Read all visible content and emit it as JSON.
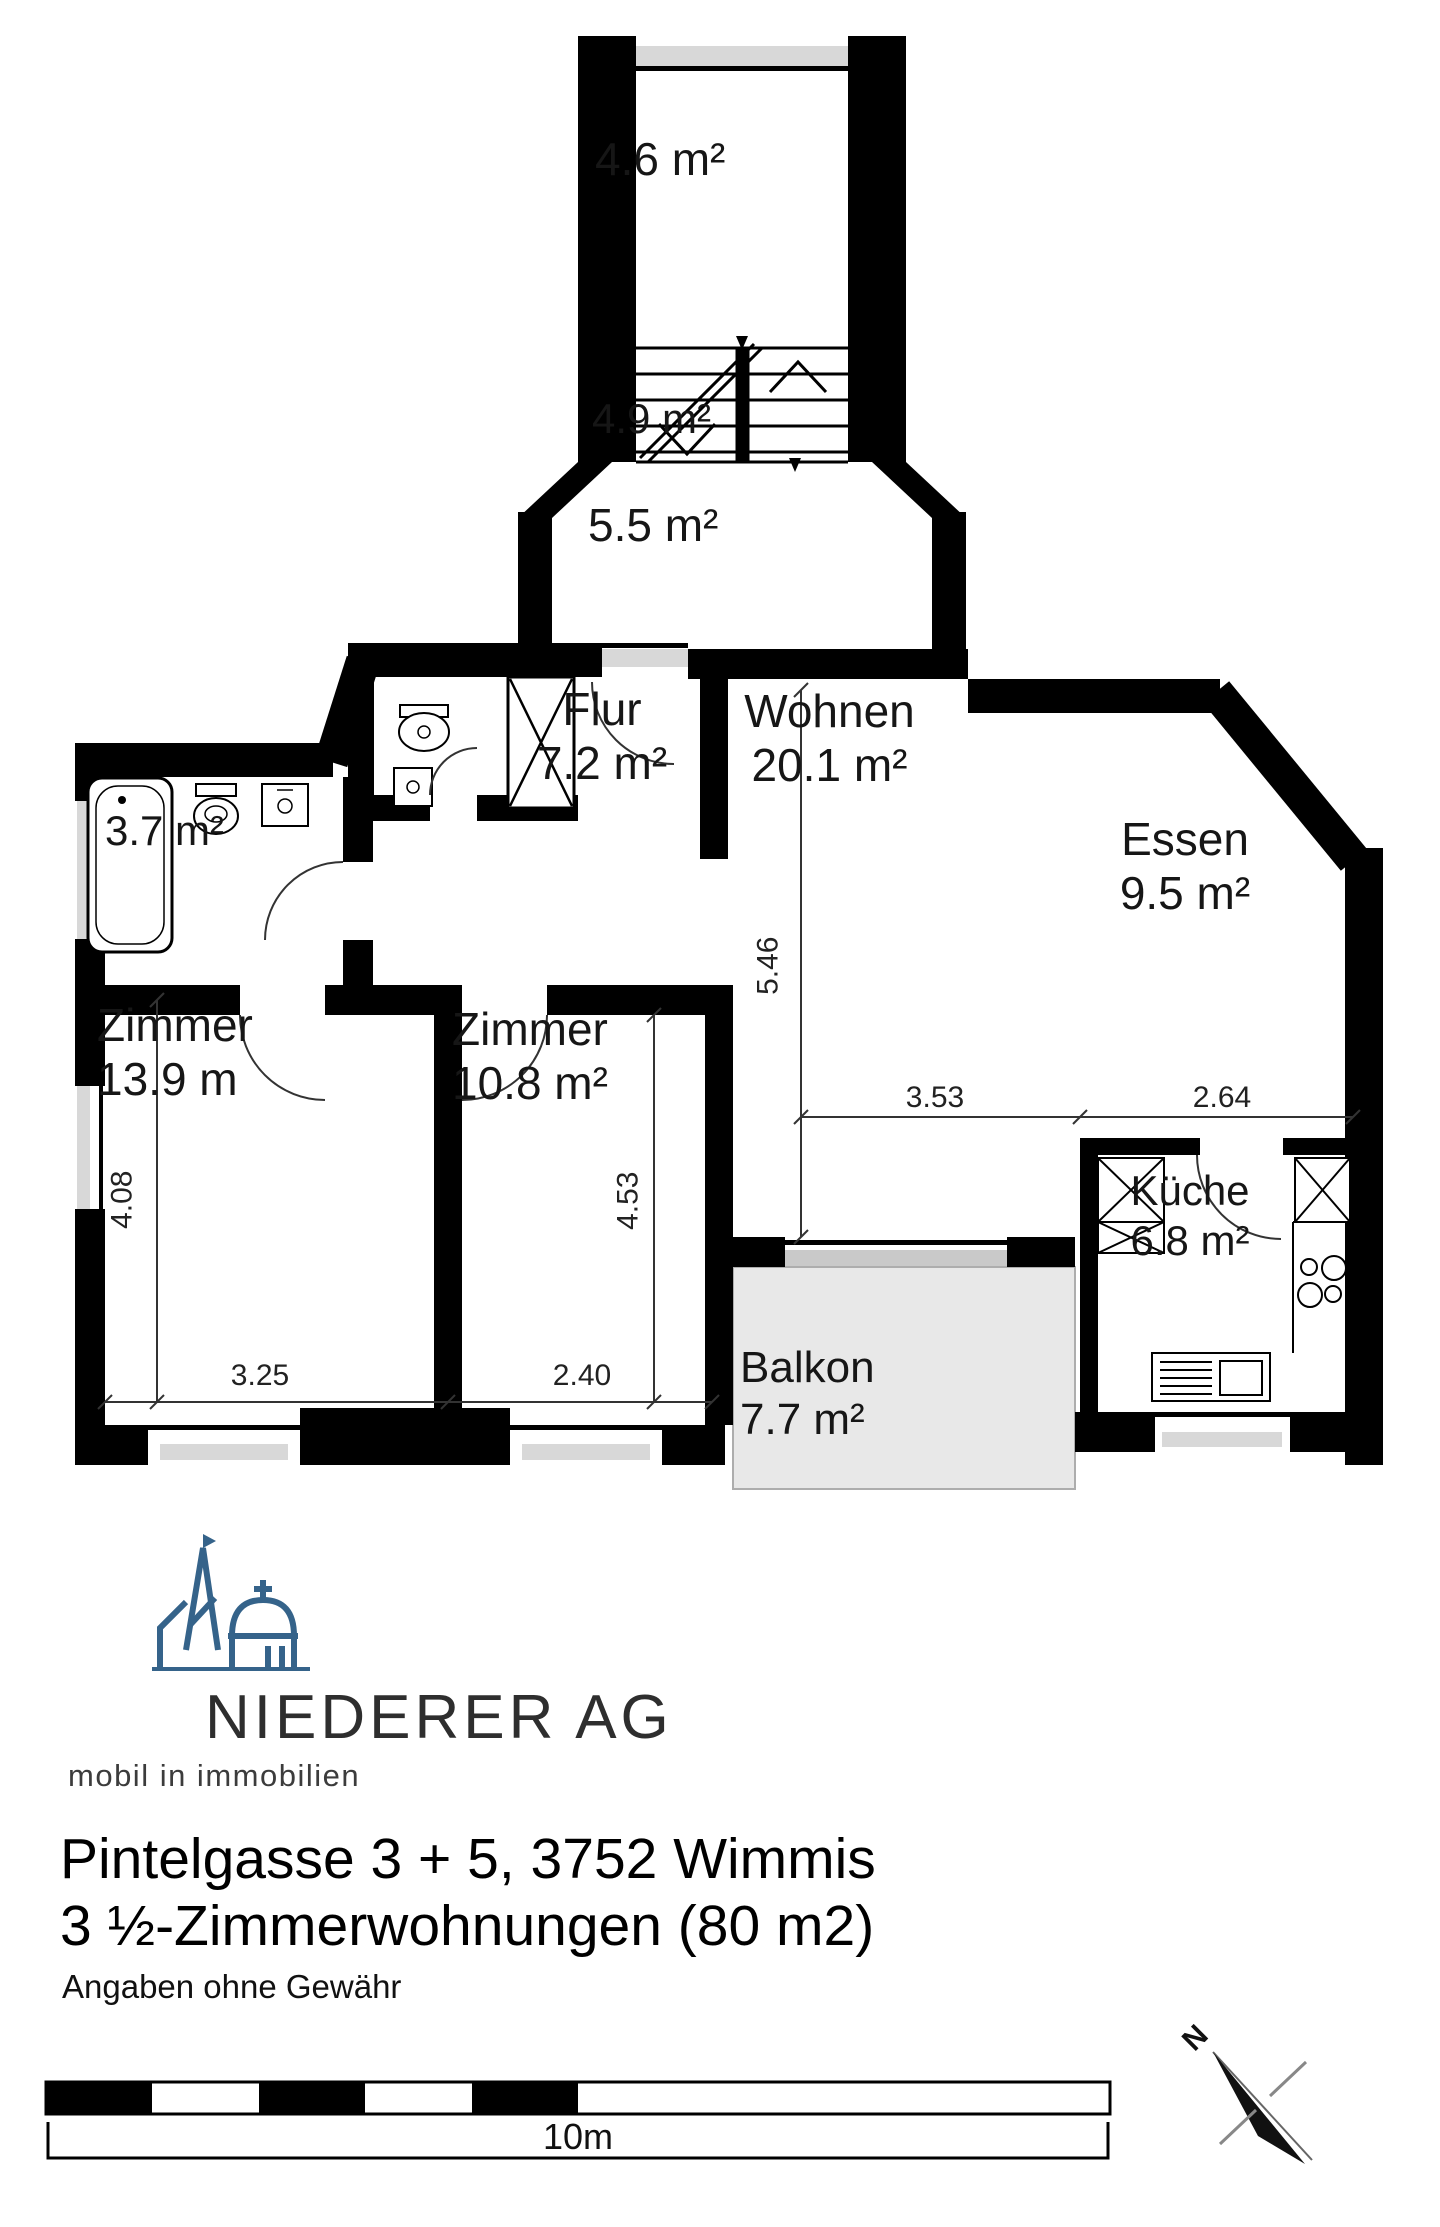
{
  "plan": {
    "labels": {
      "stairwell_upper": "4.6 m²",
      "stairs": "4.9 m²",
      "stairwell_lower": "5.5 m²",
      "flur_name": "Flur",
      "flur_area": "7.2 m²",
      "wohnen_name": "Wohnen",
      "wohnen_area": "20.1 m²",
      "essen_name": "Essen",
      "essen_area": "9.5 m²",
      "bad_area": "3.7 m²",
      "zimmer1_name": "Zimmer",
      "zimmer1_area": "13.9 m",
      "zimmer2_name": "Zimmer",
      "zimmer2_area": "10.8 m²",
      "kueche_name": "Küche",
      "kueche_area": "6.8 m²",
      "balkon_name": "Balkon",
      "balkon_area": "7.7 m²"
    },
    "dimensions": {
      "wohnen_depth": "5.46",
      "wohnen_width": "3.53",
      "kueche_width": "2.64",
      "zimmer1_depth": "4.08",
      "zimmer1_width": "3.25",
      "zimmer2_depth": "4.53",
      "zimmer2_width": "2.40"
    },
    "compass": {
      "north": "N"
    },
    "scale": {
      "label": "10m"
    }
  },
  "branding": {
    "company": "NIEDERER AG",
    "tagline": "mobil in immobilien",
    "logo_color": "#35638a"
  },
  "listing": {
    "address": "Pintelgasse 3 + 5, 3752 Wimmis",
    "unit_type": "3 ½-Zimmerwohnungen (80 m2)",
    "disclaimer": "Angaben ohne Gewähr"
  }
}
